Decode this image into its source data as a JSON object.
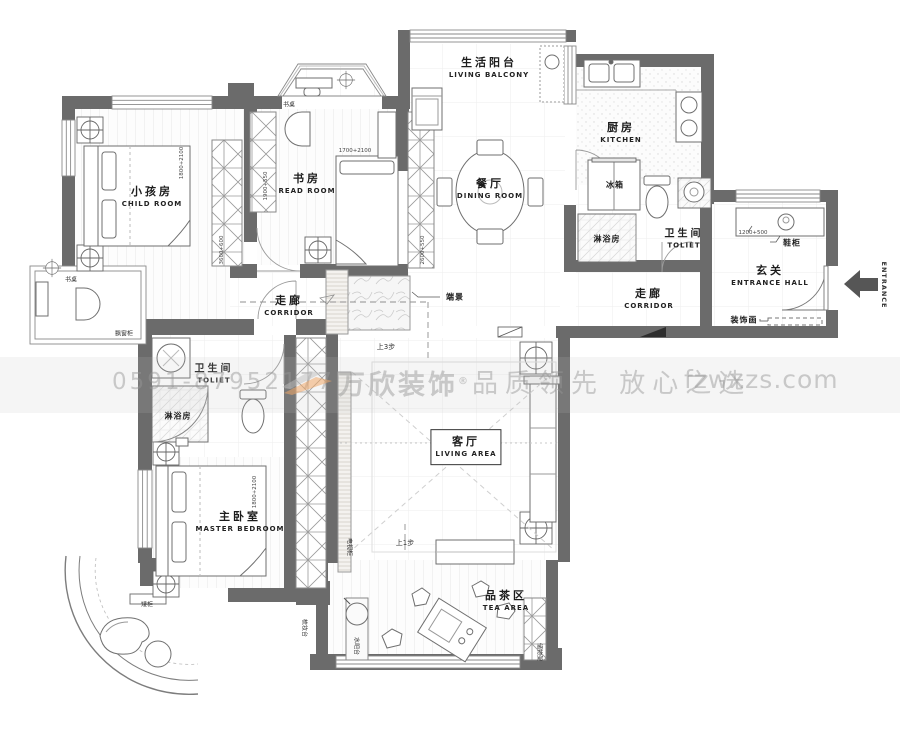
{
  "watermark": {
    "phone": "0591-87952177",
    "brand": "万欣装饰",
    "reg": "®",
    "slogan": "品质领先 放心之选",
    "site": "fzwxzs.com"
  },
  "rooms": {
    "child": {
      "cn": "小孩房",
      "en": "CHILD ROOM"
    },
    "read": {
      "cn": "书房",
      "en": "READ ROOM"
    },
    "balcony": {
      "cn": "生活阳台",
      "en": "LIVING BALCONY"
    },
    "kitchen": {
      "cn": "厨房",
      "en": "KITCHEN"
    },
    "dining": {
      "cn": "餐厅",
      "en": "DINING ROOM"
    },
    "entry": {
      "cn": "玄关",
      "en": "ENTRANCE HALL"
    },
    "toilet_top": {
      "cn": "卫生间",
      "en": "TOLIET"
    },
    "toilet_left": {
      "cn": "卫生间",
      "en": "TOLIET"
    },
    "corridor_left": {
      "cn": "走廊",
      "en": "CORRIDOR"
    },
    "corridor_right": {
      "cn": "走廊",
      "en": "CORRIDOR"
    },
    "master": {
      "cn": "主卧室",
      "en": "MASTER BEDROOM"
    },
    "living": {
      "cn": "客厅",
      "en": "LIVING AREA"
    },
    "tea": {
      "cn": "品茶区",
      "en": "TEA AREA"
    }
  },
  "fixtures": {
    "fridge": "冰箱",
    "shower_top": "淋浴房",
    "shower_left": "淋浴房",
    "shoe_cabinet": "鞋柜",
    "decor_painting": "装饰画",
    "end_scene": "端景",
    "bay_cabinet": "飘窗柜",
    "desk_top": "书桌",
    "desk_left": "书桌",
    "low_cabinet": "矮柜",
    "tv_cabinet": "电视柜",
    "water_bar": "水吧台",
    "storage_rack": "储物架",
    "dresser": "梳妆台"
  },
  "notes": {
    "step_up_3": "上3步",
    "step_up_1": "上1步",
    "entrance": "ENTRANCE"
  },
  "dimensions": {
    "child_bed": "1800+2100",
    "read_bed": "1700+2100",
    "master_bed": "1800+2100",
    "shoe_cabinet": "1200+500",
    "wardrobe_child": "3600+600",
    "wardrobe_read": "1900+550",
    "cabinet_dining": "2600+550"
  }
}
